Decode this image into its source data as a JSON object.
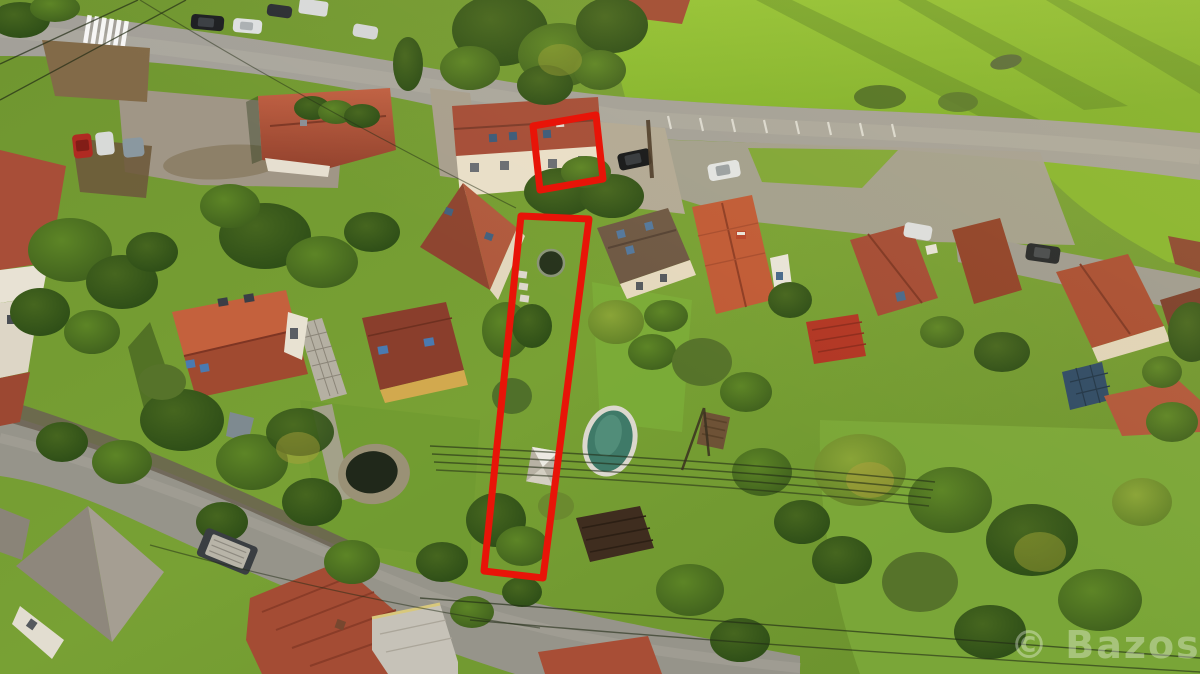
{
  "scene": {
    "type": "aerial-drone-photo",
    "summary": "Aerial view of a village: curving asphalt road on top with parked cars and a crosswalk, bright green meadow upper right, rows of family houses with red tiled roofs, gardens with trees, an oval pool, and a second street lower left. A narrow garden plot and one house half are outlined in red.",
    "watermark": "© Bazos.cz"
  },
  "highlight": {
    "color": "#e81408",
    "house_outline_label": "highlighted-house",
    "parcel_outline_label": "highlighted-narrow-parcel"
  },
  "palette": {
    "grass": "#76a032",
    "meadow": "#8cbb2f",
    "road": "#a3a099",
    "dirt": "#82694a",
    "roof_red": "#b0543a",
    "tree_dark": "#2f4f1a",
    "pool_water": "#3f7a68",
    "pool_rim": "#dcd8ce",
    "pond_water": "#20281a"
  }
}
